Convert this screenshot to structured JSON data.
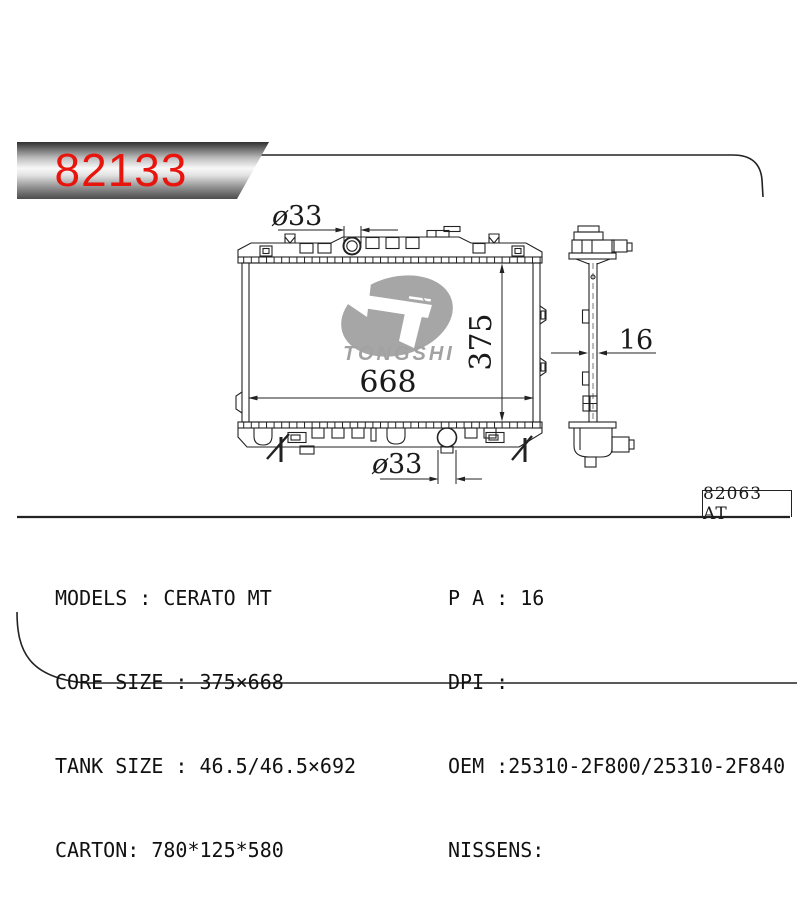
{
  "banner": {
    "part_number": "82133"
  },
  "frame": {
    "ref_label": "82063 AT"
  },
  "logo": {
    "brand": "TONGSHI",
    "registered_mark": "R"
  },
  "drawing": {
    "front": {
      "top_pipe_dia_symbol": "ø",
      "top_pipe_dia_value": "33",
      "bottom_pipe_dia_symbol": "ø",
      "bottom_pipe_dia_value": "33",
      "core_width": "668",
      "core_height": "375"
    },
    "side": {
      "thickness": "16"
    }
  },
  "specs": {
    "left": [
      "MODELS : CERATO MT",
      "CORE SIZE : 375×668",
      "TANK SIZE : 46.5/46.5×692",
      "CARTON: 780*125*580"
    ],
    "right": [
      "P A : 16",
      "DPI :",
      "OEM :25310-2F800/25310-2F840",
      "NISSENS:"
    ]
  },
  "colors": {
    "accent_red": "#e8150e",
    "logo_gray": "#a6a6a6",
    "line": "#222222"
  }
}
